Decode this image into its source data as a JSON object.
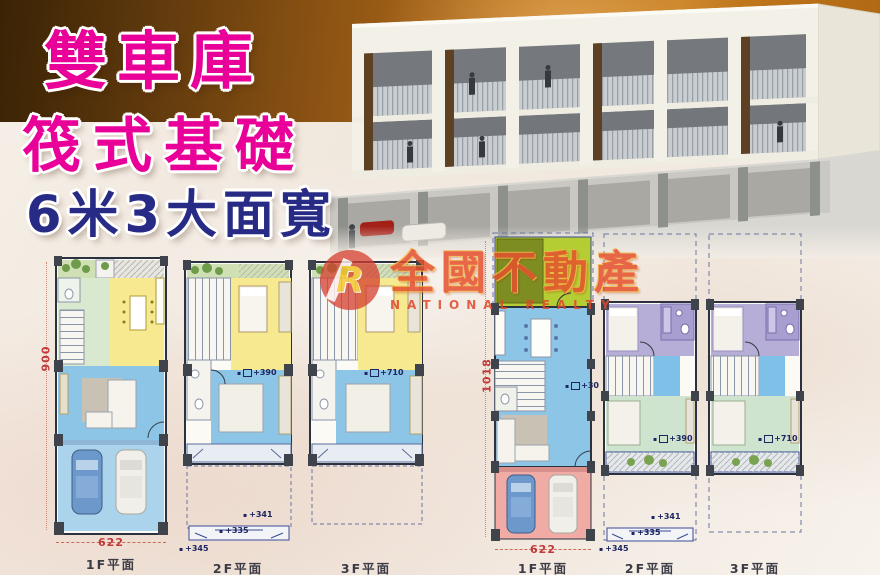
{
  "headline": {
    "line1": "雙車庫",
    "line2": "筏式基礎",
    "line3": "6米3大面寬"
  },
  "watermark": {
    "logo_letter": "R",
    "brand": "全國不動產",
    "brand_en": "NATIONAL REALTY"
  },
  "plans": {
    "left": [
      {
        "label": "1F平面",
        "bottom_dim": "622",
        "side_dim": "900"
      },
      {
        "label": "2F平面",
        "level_note": "+390",
        "canopy_note_1": "+341",
        "canopy_note_2": "+335",
        "canopy_note_3": "+345"
      },
      {
        "label": "3F平面",
        "level_note": "+710"
      }
    ],
    "right": [
      {
        "label": "1F平面",
        "bottom_dim": "622",
        "side_dim": "1018",
        "level_note": "+30"
      },
      {
        "label": "2F平面",
        "level_note": "+390",
        "canopy_note_1": "+341",
        "canopy_note_2": "+335",
        "canopy_note_3": "+345"
      },
      {
        "label": "3F平面",
        "level_note": "+710"
      }
    ]
  },
  "colors": {
    "headline_magenta": "#e80098",
    "headline_navy": "#282b85",
    "band_orange": "#b86f1b",
    "dim_red": "#c03a3a",
    "plan_blue": "#8dc5e7",
    "plan_yellow": "#f6e98f",
    "plan_green": "#d8e9d0",
    "plan_lime": "#b4cd32",
    "plan_pink": "#f0aba5",
    "plan_purple": "#b7aed7",
    "watermark_red": "#e6502d"
  }
}
